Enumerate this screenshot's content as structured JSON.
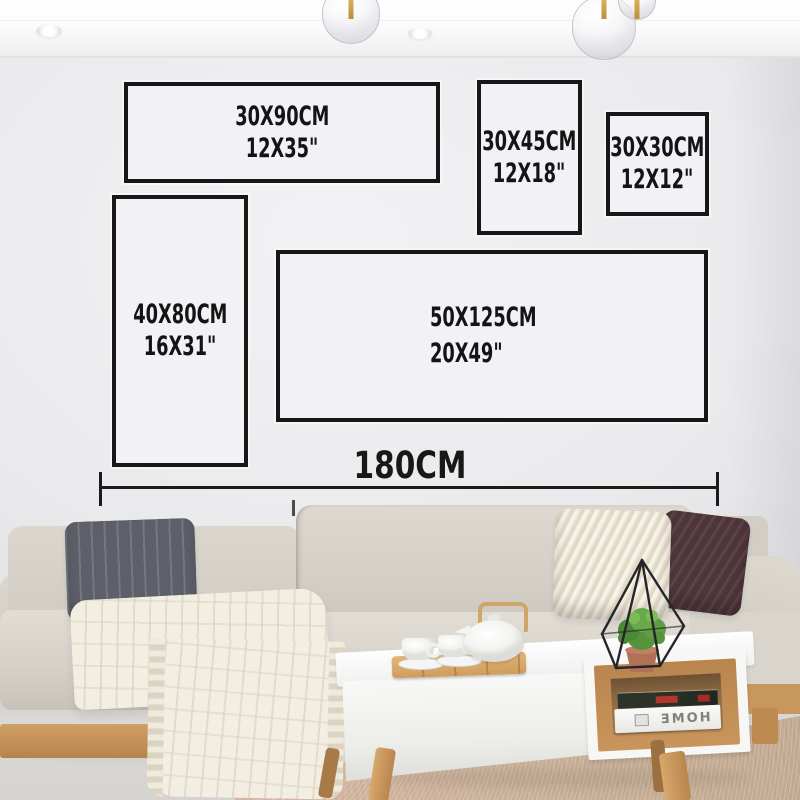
{
  "scene": {
    "type": "wall-art size guide photo",
    "objects": [
      "ceiling recessed lights",
      "glass pendant lights",
      "gray wall",
      "five size outline frames",
      "total width dimension line",
      "beige sectional sofa",
      "dark gray knit pillow",
      "cream knit pillow",
      "brown knit pillow",
      "white throw blanket",
      "white coffee table with wood shelf",
      "bamboo tea tray with cups and teapot",
      "geometric wire terrarium with green plant",
      "books on shelf",
      "beige area rug"
    ]
  },
  "size_chart": {
    "frames": [
      {
        "id": "30x90",
        "cm": "30X90CM",
        "inch": "12X35\""
      },
      {
        "id": "30x45",
        "cm": "30X45CM",
        "inch": "12X18\""
      },
      {
        "id": "30x30",
        "cm": "30X30CM",
        "inch": "12X12\""
      },
      {
        "id": "40x80",
        "cm": "40X80CM",
        "inch": "16X31\""
      },
      {
        "id": "50x125",
        "cm": "50X125CM",
        "inch": "20X49\""
      }
    ],
    "total_width_label": "180CM"
  },
  "decor": {
    "book_spine_text": "HOME"
  },
  "colors": {
    "frame_border": "#171717",
    "label_text": "#141414",
    "wall": "#e8e8eb",
    "sofa": "#d6d1c9",
    "pillow_dark_gray": "#5d6069",
    "pillow_cream": "#ece4d1",
    "pillow_brown": "#4e353a",
    "wood": "#c8955c",
    "carpet": "#ccb39b",
    "plant_green": "#5f9e42",
    "brass": "#c9a24a"
  }
}
